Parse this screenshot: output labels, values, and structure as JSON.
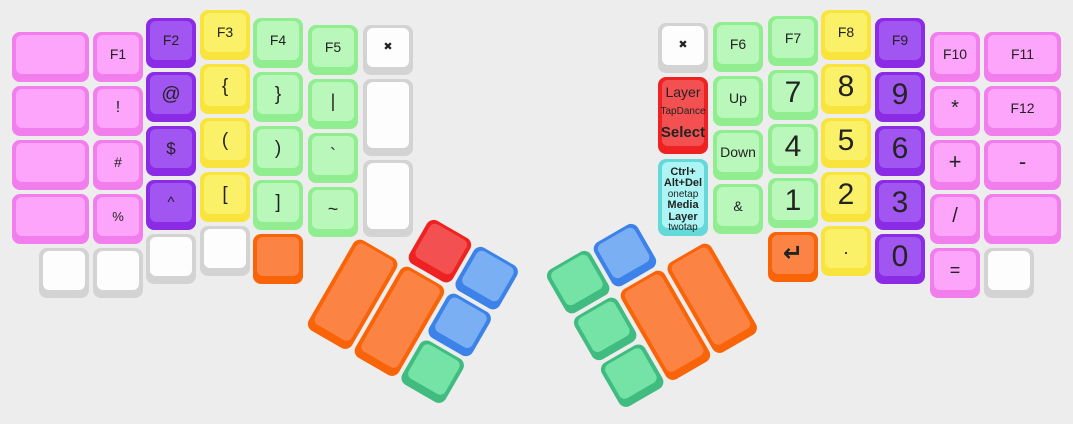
{
  "board": {
    "bg": "#ededed",
    "width": 1073,
    "height": 424
  },
  "colors": {
    "pink": {
      "edge": "#f27eee",
      "face": "#fda5fa"
    },
    "purple": {
      "edge": "#8b2be6",
      "face": "#a155f1"
    },
    "yellow": {
      "edge": "#f8e43c",
      "face": "#fbf169"
    },
    "lgreen": {
      "edge": "#90ee90",
      "face": "#baf7ba"
    },
    "white": {
      "edge": "#d3d3d3",
      "face": "#fdfdfd"
    },
    "red": {
      "edge": "#ee2222",
      "face": "#f35151"
    },
    "cyan": {
      "edge": "#63d9d9",
      "face": "#adf5f5"
    },
    "orange": {
      "edge": "#f96408",
      "face": "#fb8445"
    },
    "blue": {
      "edge": "#3c82e8",
      "face": "#7aaff4"
    },
    "cgreen": {
      "edge": "#41bc80",
      "face": "#74e3a5"
    }
  },
  "halves": {
    "left": {
      "keys": [
        {
          "n": "blank",
          "c": "pink",
          "x": 12,
          "y": 32,
          "w": 77
        },
        {
          "n": "blank",
          "c": "pink",
          "x": 12,
          "y": 86,
          "w": 77
        },
        {
          "n": "blank",
          "c": "pink",
          "x": 12,
          "y": 140,
          "w": 77
        },
        {
          "n": "blank",
          "c": "pink",
          "x": 12,
          "y": 194,
          "w": 77
        },
        {
          "n": "blank",
          "c": "white",
          "x": 39,
          "y": 248
        },
        {
          "n": "f1",
          "c": "pink",
          "x": 93,
          "y": 32,
          "l": "F1",
          "fs": 14
        },
        {
          "n": "exclamation",
          "c": "pink",
          "x": 93,
          "y": 86,
          "l": "!",
          "fs": 16
        },
        {
          "n": "hash",
          "c": "pink",
          "x": 93,
          "y": 140,
          "l": "#",
          "fs": 14
        },
        {
          "n": "percent",
          "c": "pink",
          "x": 93,
          "y": 194,
          "l": "%",
          "fs": 13
        },
        {
          "n": "blank",
          "c": "white",
          "x": 93,
          "y": 248
        },
        {
          "n": "f2",
          "c": "purple",
          "x": 146,
          "y": 18,
          "l": "F2",
          "fs": 14
        },
        {
          "n": "at",
          "c": "purple",
          "x": 146,
          "y": 72,
          "l": "@",
          "fs": 19
        },
        {
          "n": "dollar",
          "c": "purple",
          "x": 146,
          "y": 126,
          "l": "$",
          "fs": 17
        },
        {
          "n": "caret",
          "c": "purple",
          "x": 146,
          "y": 180,
          "l": "^",
          "fs": 15
        },
        {
          "n": "blank",
          "c": "white",
          "x": 146,
          "y": 234
        },
        {
          "n": "f3",
          "c": "yellow",
          "x": 200,
          "y": 10,
          "l": "F3",
          "fs": 14
        },
        {
          "n": "left-brace",
          "c": "yellow",
          "x": 200,
          "y": 64,
          "l": "{",
          "fs": 19
        },
        {
          "n": "left-paren",
          "c": "yellow",
          "x": 200,
          "y": 118,
          "l": "(",
          "fs": 19
        },
        {
          "n": "left-bracket",
          "c": "yellow",
          "x": 200,
          "y": 172,
          "l": "[",
          "fs": 19
        },
        {
          "n": "blank",
          "c": "white",
          "x": 200,
          "y": 226
        },
        {
          "n": "f4",
          "c": "lgreen",
          "x": 253,
          "y": 18,
          "l": "F4",
          "fs": 14
        },
        {
          "n": "right-brace",
          "c": "lgreen",
          "x": 253,
          "y": 72,
          "l": "}",
          "fs": 19
        },
        {
          "n": "right-paren",
          "c": "lgreen",
          "x": 253,
          "y": 126,
          "l": ")",
          "fs": 19
        },
        {
          "n": "right-bracket",
          "c": "lgreen",
          "x": 253,
          "y": 180,
          "l": "]",
          "fs": 19
        },
        {
          "n": "blank",
          "c": "orange",
          "x": 253,
          "y": 234
        },
        {
          "n": "f5",
          "c": "lgreen",
          "x": 308,
          "y": 25,
          "l": "F5",
          "fs": 14
        },
        {
          "n": "pipe",
          "c": "lgreen",
          "x": 308,
          "y": 79,
          "l": "|",
          "fs": 18
        },
        {
          "n": "backtick",
          "c": "lgreen",
          "x": 308,
          "y": 133,
          "l": "`",
          "fs": 18
        },
        {
          "n": "tilde",
          "c": "lgreen",
          "x": 308,
          "y": 187,
          "l": "~",
          "fs": 18
        },
        {
          "n": "none",
          "c": "white",
          "x": 363,
          "y": 25,
          "l": "✖",
          "fs": 11,
          "b": true,
          "icon": "x-icon"
        },
        {
          "n": "blank",
          "c": "white",
          "x": 363,
          "y": 79,
          "h": 77
        },
        {
          "n": "blank",
          "c": "white",
          "x": 363,
          "y": 160,
          "h": 77
        }
      ]
    },
    "right": {
      "keys": [
        {
          "n": "none",
          "c": "white",
          "x": 658,
          "y": 23,
          "l": "✖",
          "fs": 11,
          "b": true,
          "icon": "x-icon"
        },
        {
          "n": "layer-tapdance-select",
          "c": "red",
          "x": 658,
          "y": 77,
          "h": 77,
          "lines": [
            {
              "t": "Layer",
              "fs": 14
            },
            {
              "t": "TapDance",
              "fs": 10
            },
            {
              "t": "Select",
              "fs": 15,
              "b": true
            }
          ]
        },
        {
          "n": "ctrl-alt-del-media-layer",
          "c": "cyan",
          "x": 658,
          "y": 159,
          "h": 77,
          "lines": [
            {
              "t": "Ctrl+",
              "fs": 11,
              "b": true
            },
            {
              "t": "Alt+Del",
              "fs": 11,
              "b": true
            },
            {
              "t": "onetap",
              "fs": 10
            },
            {
              "t": "Media",
              "fs": 11,
              "b": true
            },
            {
              "t": "Layer",
              "fs": 11,
              "b": true
            },
            {
              "t": "twotap",
              "fs": 10
            }
          ]
        },
        {
          "n": "f6",
          "c": "lgreen",
          "x": 713,
          "y": 22,
          "l": "F6",
          "fs": 14
        },
        {
          "n": "up",
          "c": "lgreen",
          "x": 713,
          "y": 76,
          "l": "Up",
          "fs": 14
        },
        {
          "n": "down",
          "c": "lgreen",
          "x": 713,
          "y": 130,
          "l": "Down",
          "fs": 14
        },
        {
          "n": "ampersand",
          "c": "lgreen",
          "x": 713,
          "y": 184,
          "l": "&",
          "fs": 14
        },
        {
          "n": "f7",
          "c": "lgreen",
          "x": 768,
          "y": 16,
          "l": "F7",
          "fs": 14
        },
        {
          "n": "num-7",
          "c": "lgreen",
          "x": 768,
          "y": 70,
          "l": "7",
          "fs": 30
        },
        {
          "n": "num-4",
          "c": "lgreen",
          "x": 768,
          "y": 124,
          "l": "4",
          "fs": 30
        },
        {
          "n": "num-1",
          "c": "lgreen",
          "x": 768,
          "y": 178,
          "l": "1",
          "fs": 30
        },
        {
          "n": "enter",
          "c": "orange",
          "x": 768,
          "y": 232,
          "l": "↵",
          "fs": 24,
          "b": true,
          "icon": "enter-icon"
        },
        {
          "n": "f8",
          "c": "yellow",
          "x": 821,
          "y": 10,
          "l": "F8",
          "fs": 14
        },
        {
          "n": "num-8",
          "c": "yellow",
          "x": 821,
          "y": 64,
          "l": "8",
          "fs": 30
        },
        {
          "n": "num-5",
          "c": "yellow",
          "x": 821,
          "y": 118,
          "l": "5",
          "fs": 30
        },
        {
          "n": "num-2",
          "c": "yellow",
          "x": 821,
          "y": 172,
          "l": "2",
          "fs": 30
        },
        {
          "n": "decimal-point",
          "c": "yellow",
          "x": 821,
          "y": 226,
          "l": ".",
          "fs": 18
        },
        {
          "n": "f9",
          "c": "purple",
          "x": 875,
          "y": 18,
          "l": "F9",
          "fs": 14
        },
        {
          "n": "num-9",
          "c": "purple",
          "x": 875,
          "y": 72,
          "l": "9",
          "fs": 30
        },
        {
          "n": "num-6",
          "c": "purple",
          "x": 875,
          "y": 126,
          "l": "6",
          "fs": 30
        },
        {
          "n": "num-3",
          "c": "purple",
          "x": 875,
          "y": 180,
          "l": "3",
          "fs": 30
        },
        {
          "n": "num-0",
          "c": "purple",
          "x": 875,
          "y": 234,
          "l": "0",
          "fs": 30
        },
        {
          "n": "f10",
          "c": "pink",
          "x": 930,
          "y": 32,
          "l": "F10",
          "fs": 14
        },
        {
          "n": "asterisk",
          "c": "pink",
          "x": 930,
          "y": 86,
          "l": "*",
          "fs": 20
        },
        {
          "n": "plus",
          "c": "pink",
          "x": 930,
          "y": 140,
          "l": "+",
          "fs": 22
        },
        {
          "n": "slash",
          "c": "pink",
          "x": 930,
          "y": 194,
          "l": "/",
          "fs": 20
        },
        {
          "n": "equals",
          "c": "pink",
          "x": 930,
          "y": 248,
          "l": "=",
          "fs": 18
        },
        {
          "n": "f11",
          "c": "pink",
          "x": 984,
          "y": 32,
          "w": 77,
          "l": "F11",
          "fs": 14
        },
        {
          "n": "f12",
          "c": "pink",
          "x": 984,
          "y": 86,
          "w": 77,
          "l": "F12",
          "fs": 14
        },
        {
          "n": "minus",
          "c": "pink",
          "x": 984,
          "y": 140,
          "w": 77,
          "l": "-",
          "fs": 22
        },
        {
          "n": "blank",
          "c": "pink",
          "x": 984,
          "y": 194,
          "w": 77
        },
        {
          "n": "blank",
          "c": "white",
          "x": 984,
          "y": 248
        }
      ]
    }
  },
  "clusters": {
    "left": {
      "x": 384,
      "y": 190,
      "angle": 30,
      "keys": [
        {
          "n": "thumb-red",
          "c": "red",
          "x": 54,
          "y": 0
        },
        {
          "n": "thumb-blue-1",
          "c": "blue",
          "x": 108,
          "y": 0
        },
        {
          "n": "thumb-blue-2",
          "c": "blue",
          "x": 108,
          "y": 54
        },
        {
          "n": "thumb-green",
          "c": "cgreen",
          "x": 108,
          "y": 108
        },
        {
          "n": "thumb-orange-1",
          "c": "orange",
          "x": 0,
          "y": 54,
          "h": 104
        },
        {
          "n": "thumb-orange-2",
          "c": "orange",
          "x": 54,
          "y": 54,
          "h": 104
        }
      ]
    },
    "right": {
      "x": 544,
      "y": 273,
      "angle": -30,
      "keys": [
        {
          "n": "thumb-green-1",
          "c": "cgreen",
          "x": 0,
          "y": 0
        },
        {
          "n": "thumb-green-2",
          "c": "cgreen",
          "x": 0,
          "y": 54
        },
        {
          "n": "thumb-green-3",
          "c": "cgreen",
          "x": 0,
          "y": 108
        },
        {
          "n": "thumb-blue",
          "c": "blue",
          "x": 54,
          "y": 0
        },
        {
          "n": "thumb-orange-1",
          "c": "orange",
          "x": 54,
          "y": 54,
          "h": 104
        },
        {
          "n": "thumb-orange-2",
          "c": "orange",
          "x": 108,
          "y": 54,
          "h": 104
        }
      ]
    }
  }
}
